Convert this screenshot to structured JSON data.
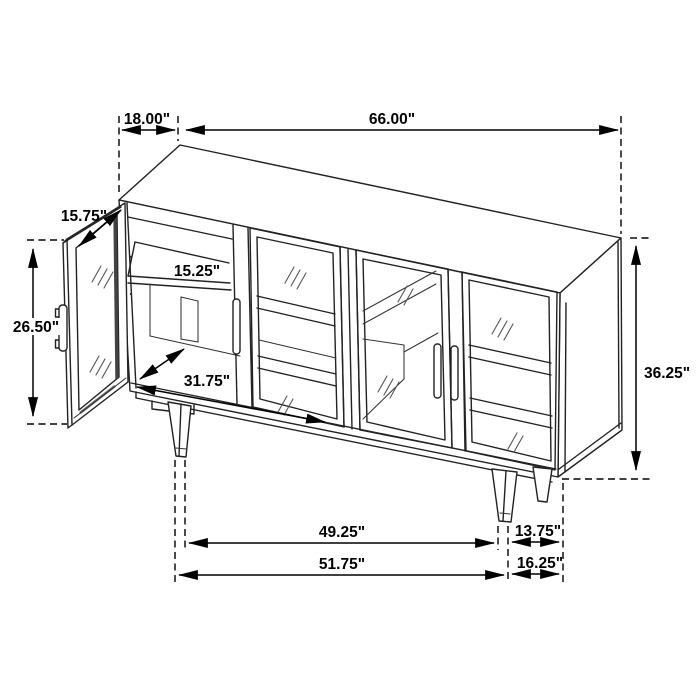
{
  "diagram": {
    "kind": "furniture dimension line drawing",
    "unit": "inches",
    "colors": {
      "line": "#222222",
      "annotation": "#000000",
      "background": "#ffffff"
    }
  },
  "dims": {
    "top_depth": "18.00\"",
    "overall_width": "66.00\"",
    "door_width": "15.75\"",
    "door_height": "26.50\"",
    "shelf_depth": "15.25\"",
    "interior_width": "31.75\"",
    "overall_height": "36.25\"",
    "leg_span_inner": "49.25\"",
    "leg_side_span": "13.75\"",
    "leg_span_outer": "51.75\"",
    "side_depth": "16.25\""
  }
}
